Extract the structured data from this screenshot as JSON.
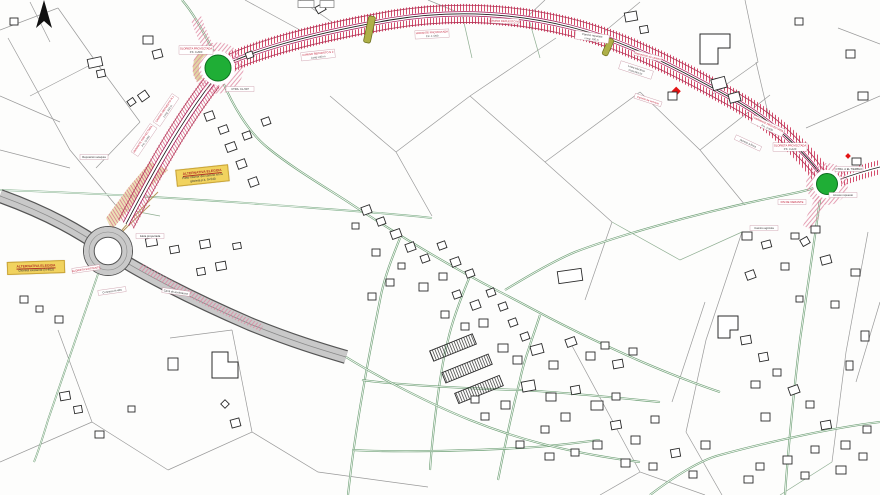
{
  "map": {
    "type": "road-project-site-plan",
    "background": "#fdfdfc"
  },
  "colors": {
    "corridor_tick_red": "#cf3b5e",
    "corridor_magenta": "#a01050",
    "corridor_centerline": "#1c1c1c",
    "roundabout_green": "#1fae36",
    "highway_gray": "#c9c9c9",
    "road_green": "#6fa076",
    "parcel_gray": "#9a9a9a",
    "building_outline": "#2b2b2b",
    "note_yellow": "#f1d35f",
    "overpass_olive": "#aeb048",
    "marker_red": "#e31414"
  },
  "north_arrow": {
    "name": "north-arrow"
  },
  "notes": {
    "note1": {
      "line1": "ALTERNATIVA ELEGIDA",
      "line2": "Paso inferior del camino en la",
      "line3": "glorieta p.k. 0+540"
    },
    "note2": {
      "line1": "ALTERNATIVA ELEGIDA",
      "line2": "Glorieta existente (N-403)"
    }
  },
  "labels": [
    {
      "t1": "CAMINO REPUESTO N 2",
      "t2": "Long: 240 m",
      "c": "r"
    },
    {
      "t1": "VARIANTE PROYECTADA",
      "t2": "P.K. 1+200",
      "c": "r"
    },
    {
      "t1": "CAMINO REPUESTO N 3",
      "c": "r"
    },
    {
      "t1": "Camino repuesto",
      "t2": "Long: 180 m",
      "c": "k"
    },
    {
      "t1": "Reposicion de camino",
      "c": "r"
    },
    {
      "t1": "Linea electrica",
      "t2": "Cota 664,20",
      "c": "k"
    },
    {
      "t1": "Camino de servicio",
      "c": "r"
    },
    {
      "t1": "VARIANTE PROYECTADA",
      "t2": "P.K. 2+600",
      "c": "r"
    },
    {
      "t1": "Acceso a finca",
      "c": "k"
    },
    {
      "t1": "CAMINO REPUESTO N 1",
      "t2": "Long: 310 m",
      "c": "r"
    },
    {
      "t1": "VARIANTE PROYECTADA",
      "t2": "P.K. 0+400",
      "c": "r"
    },
    {
      "t1": "Reposicion acequia",
      "c": "k"
    },
    {
      "t1": "GLORIETA PROYECTADA",
      "t2": "P.K. 0+660",
      "c": "r"
    },
    {
      "t1": "CTRA. CL-507",
      "c": "k"
    },
    {
      "t1": "GLORIETA EXISTENTE",
      "c": "r"
    },
    {
      "t1": "Conexion N-403",
      "c": "k"
    },
    {
      "t1": "Isleta proyectada",
      "c": "k"
    },
    {
      "t1": "Carril de aceleracion",
      "c": "k"
    },
    {
      "t1": "GLORIETA PROYECTADA",
      "t2": "P.K. 3+120",
      "c": "r"
    },
    {
      "t1": "CTRA. A EL TIEMBLO",
      "c": "k"
    },
    {
      "t1": "FIN DE VARIANTE",
      "c": "r"
    },
    {
      "t1": "Camino agricola",
      "c": "k"
    },
    {
      "t1": "Acceso repuesto",
      "c": "k"
    }
  ]
}
